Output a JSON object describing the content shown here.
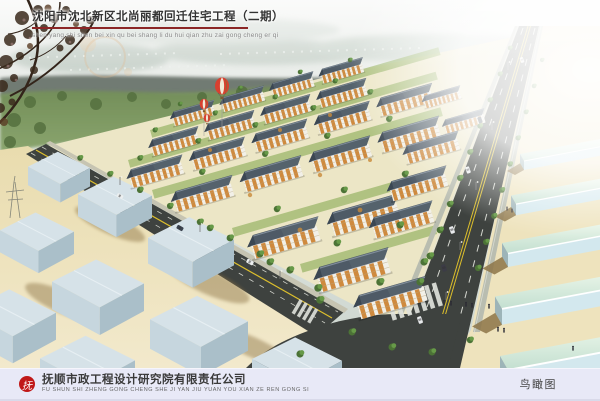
{
  "header": {
    "title": "沈阳市沈北新区北尚丽都回迁住宅工程（二期）",
    "pinyin": "shen yang shi shen bei xin qu bei shang li du hui qian zhu zai gong cheng er qi"
  },
  "footer": {
    "logo_glyph": "抚",
    "company": "抚顺市政工程设计研究院有限责任公司",
    "company_pinyin": "FU SHUN SHI ZHENG GONG CHENG SHE JI YAN JIU YUAN YOU XIAN ZE REN GONG SI",
    "view_label": "鸟瞰图"
  },
  "colors": {
    "underline": "#8b2626",
    "footer_bg": "#e8e9f7",
    "logo_red": "#c01818",
    "road_asphalt": "#3e423f",
    "lane_yellow": "#ddbf2c",
    "sand": "#ecdfb2",
    "roof_slate": "#4e5a66",
    "facade_orange": "#cf8a3e",
    "facade_white": "#f2f0e8",
    "warehouse_blue": "#c6d6de",
    "warehouse_mint": "#d7ecdc",
    "tree_green": "#4c7336",
    "balloon_red": "#d84030"
  }
}
